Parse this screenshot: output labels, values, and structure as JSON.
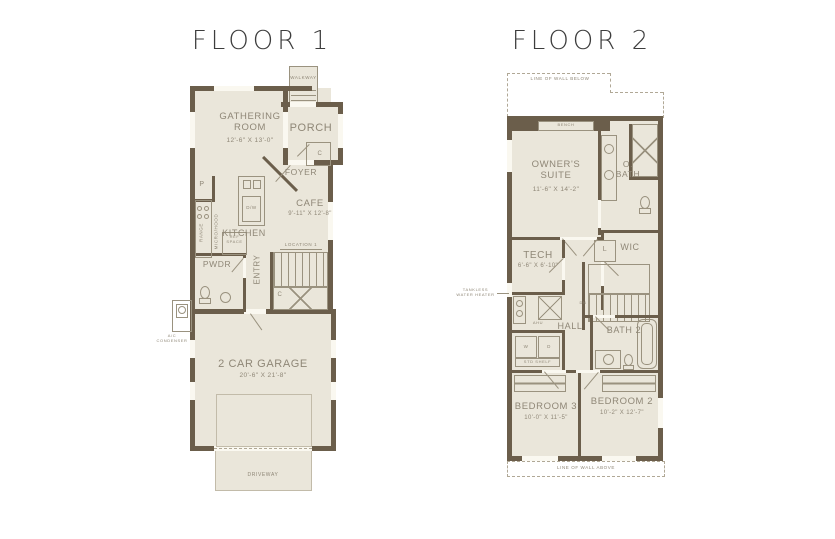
{
  "colors": {
    "wall": "#6b5e4b",
    "room-fill": "#eae6da",
    "line": "#9a927f",
    "label": "#8f8777",
    "title": "#3d3d3d",
    "window": "#faf8f0",
    "dashed": "#b0a896",
    "light-line": "#c2bba9"
  },
  "floor1": {
    "title": "FLOOR 1",
    "labels": {
      "walkway": "WALKWAY",
      "porch": "PORCH",
      "gathering_name": "GATHERING\nROOM",
      "gathering_dims": "12'-6\" X 13'-0\"",
      "foyer": "FOYER",
      "closet_foyer": "C",
      "pantry": "P",
      "cafe_name": "CAFE",
      "cafe_dims": "9'-11\" X 12'-8\"",
      "kitchen": "KITCHEN",
      "range": "RANGE",
      "micro_hood": "MICRO/HOOD",
      "dw": "D/W",
      "ref_space": "REF\nSPACE",
      "pwdr": "PWDR",
      "entry": "ENTRY",
      "location": "LOCATION 1",
      "closet_stairs": "C",
      "garage_name": "2 CAR GARAGE",
      "garage_dims": "20'-6\" X 21'-8\"",
      "driveway": "DRIVEWAY",
      "ac_condenser": "A/C\nCONDENSER"
    }
  },
  "floor2": {
    "title": "FLOOR 2",
    "labels": {
      "line_below": "LINE OF WALL BELOW",
      "bench": "BENCH",
      "owners_name": "OWNER'S\nSUITE",
      "owners_dims": "11'-6\" X 14'-2\"",
      "obath": "O.\nBATH",
      "wic": "WIC",
      "linen": "L",
      "tech_name": "TECH",
      "tech_dims": "6'-6\" X 6'-10\"",
      "tankless": "TANKLESS\nWATER HEATER",
      "ahu": "AHU",
      "dn": "DN",
      "hall": "HALL",
      "bath2": "BATH 2",
      "washer": "W",
      "dryer": "D",
      "std_shelf": "STD SHELF",
      "bedroom3_name": "BEDROOM 3",
      "bedroom3_dims": "10'-0\" X 11'-5\"",
      "bedroom2_name": "BEDROOM 2",
      "bedroom2_dims": "10'-2\" X 12'-7\"",
      "line_above": "LINE OF WALL ABOVE"
    }
  }
}
